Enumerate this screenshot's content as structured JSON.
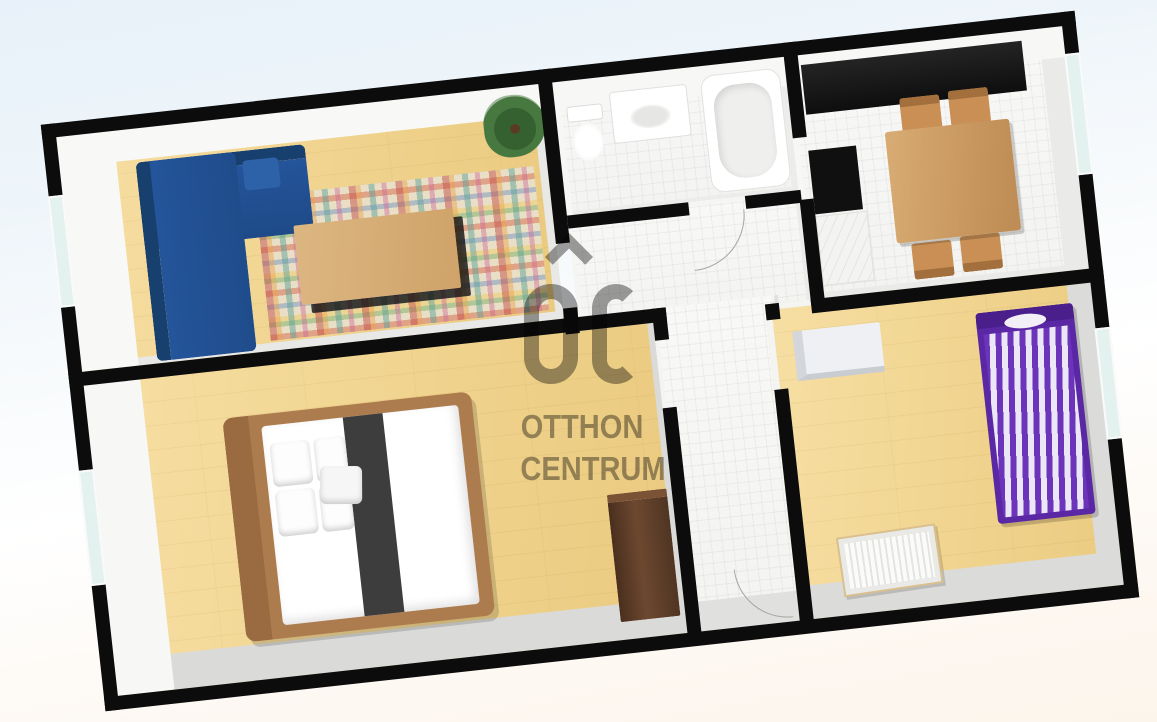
{
  "watermark": {
    "line1": "OTTHON",
    "line2": "CENTRUM",
    "logo": "oc-roof-monogram-icon",
    "color": "#8d8d8d"
  },
  "scene": {
    "type": "3d-floor-plan-top-view",
    "rotation_deg": -6.3,
    "wall_color": "#0c0c0c",
    "floor_colors": {
      "wood": "#efd28c",
      "tile": "#f5f5f3"
    },
    "background_gradient": [
      "#e8f1f9",
      "#ffffff",
      "#fcf5ec"
    ],
    "rooms": [
      {
        "name": "living-room",
        "floor": "wood",
        "furniture": [
          "corner-sofa-blue",
          "plaid-rug",
          "coffee-table",
          "potted-plant"
        ],
        "windows": 1,
        "accent": "#21508e"
      },
      {
        "name": "master-bedroom",
        "floor": "wood",
        "furniture": [
          "double-bed",
          "pillows",
          "dark-runner",
          "wardrobe-dark-brown"
        ],
        "windows": 1
      },
      {
        "name": "bathroom",
        "floor": "tile",
        "furniture": [
          "toilet",
          "sink-vanity",
          "bathtub"
        ],
        "windows": 0
      },
      {
        "name": "hallway",
        "floor": "tile",
        "furniture": [],
        "windows": 0
      },
      {
        "name": "kitchen-dining",
        "floor": "tile",
        "furniture": [
          "black-counter-run",
          "stove-black",
          "white-worktop",
          "dining-table",
          "dining-chair",
          "dining-chair",
          "dining-chair",
          "dining-chair"
        ],
        "windows": 1
      },
      {
        "name": "kids-bedroom",
        "floor": "wood",
        "furniture": [
          "white-dresser",
          "single-bed-purple-striped",
          "crib"
        ],
        "windows": 1,
        "accent": "#5a28a4"
      }
    ]
  }
}
